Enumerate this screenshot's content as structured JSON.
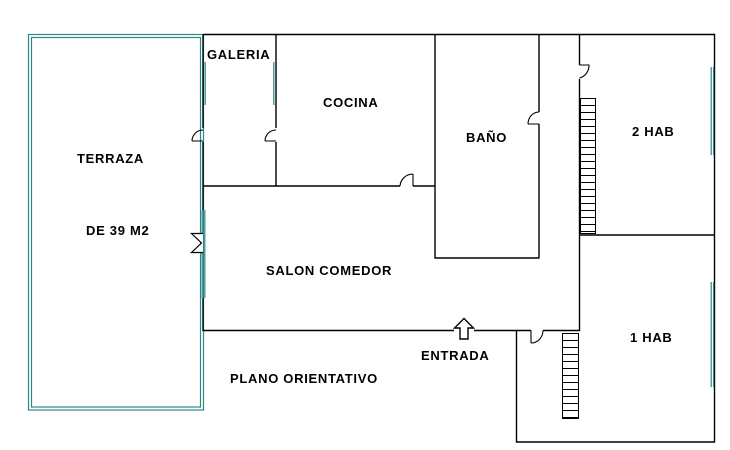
{
  "title": "PLANO ORIENTATIVO",
  "colors": {
    "wall": "#000000",
    "window_accent": "#2d8686",
    "background": "#ffffff",
    "text": "#000000"
  },
  "rooms": {
    "terraza": {
      "label": "TERRAZA",
      "size_label": "DE 39 M2"
    },
    "galeria": {
      "label": "GALERIA"
    },
    "cocina": {
      "label": "COCINA"
    },
    "bano": {
      "label": "BAÑO"
    },
    "hab2": {
      "label": "2 HAB"
    },
    "salon": {
      "label": "SALON COMEDOR"
    },
    "hab1": {
      "label": "1 HAB"
    }
  },
  "entrance": {
    "label": "ENTRADA",
    "arrow": "up-block-arrow"
  },
  "footer_note": "PLANO ORIENTATIVO",
  "features": {
    "windows": [
      "galeria-terraza",
      "salon-terraza",
      "hab2-east",
      "hab1-east"
    ],
    "radiators": [
      "hab2-west",
      "hab1-west"
    ],
    "shutter_symbol": "salon-terraza-window"
  }
}
